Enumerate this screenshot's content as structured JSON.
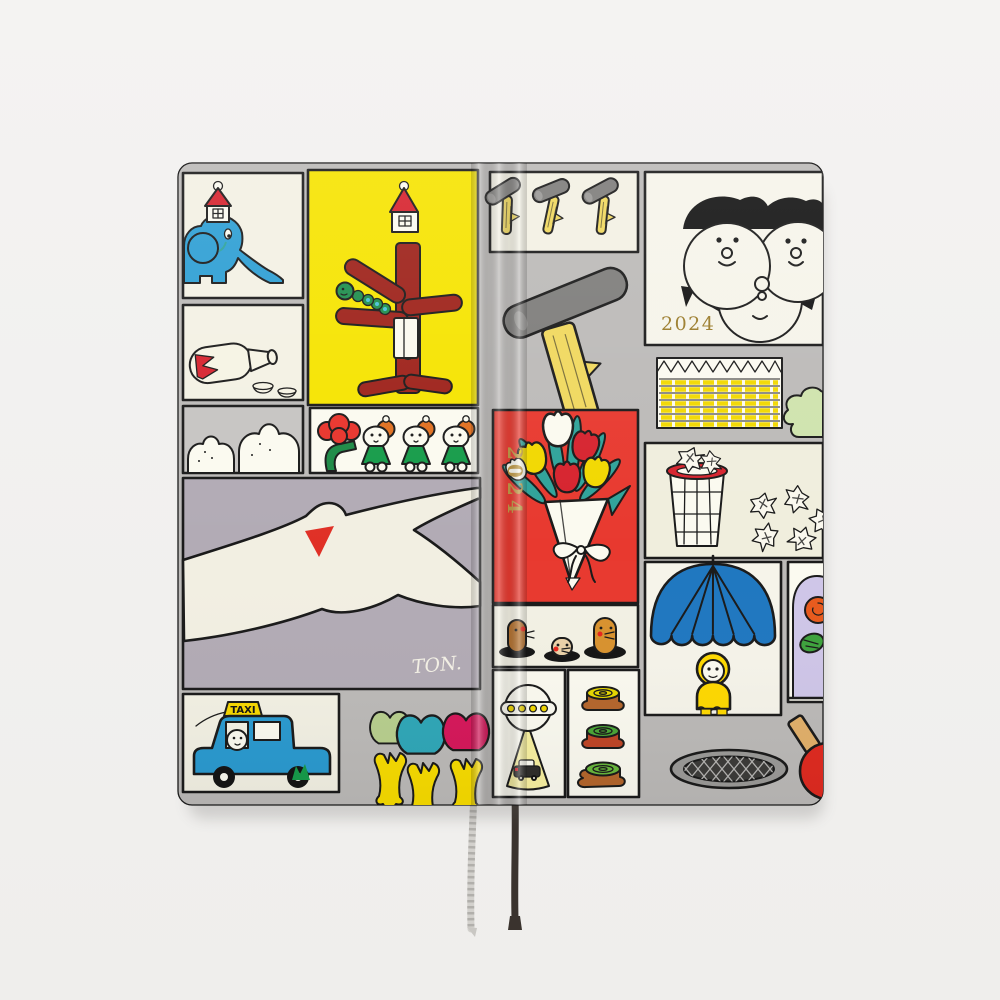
{
  "cover": {
    "front_year": "2024",
    "spine_year": "2024",
    "taxi_sign": "TAXI",
    "signature": "TON.",
    "colors": {
      "backdrop": "#f2f1f0",
      "cover_gray": "#bcbab8",
      "panel_cream": "#f3f1e4",
      "panel_white": "#fbfaf0",
      "trash_cream": "#f0eedd",
      "yellow": "#f6e400",
      "red": "#e8392f",
      "dark_red": "#9e221a",
      "bright_red": "#d6232e",
      "blue": "#2e9fd4",
      "taxi_blue": "#2a9ad0",
      "umbrella_blue": "#1f77c0",
      "teal": "#2fa39a",
      "green": "#169c4a",
      "lavender": "#b2abb5",
      "gold": "#9a7b2a",
      "spine_gold": "#c09a45",
      "crimson": "#d6175a",
      "hand_yellow": "#f8dc00",
      "wood_yellow": "#f0d85e",
      "hammer_gray": "#7e7d7b",
      "outline": "#1a1a1a"
    },
    "panels": [
      "elephant-with-house",
      "red-tree-and-tower",
      "sake-bottle-and-cups",
      "clouds",
      "flower-and-children",
      "seagull",
      "taxi",
      "hammers-trio",
      "big-hammer",
      "twin-faces",
      "ruled-note-paper",
      "waste-basket",
      "tulip-bouquet",
      "moles-in-holes",
      "ufo-and-car",
      "tree-stumps",
      "umbrella-figure",
      "rose-in-dome",
      "tulip-hands",
      "street-grate",
      "ping-pong-paddle",
      "green-blob"
    ]
  },
  "bookmarks": [
    {
      "name": "silver-cord"
    },
    {
      "name": "black-ribbon"
    }
  ]
}
